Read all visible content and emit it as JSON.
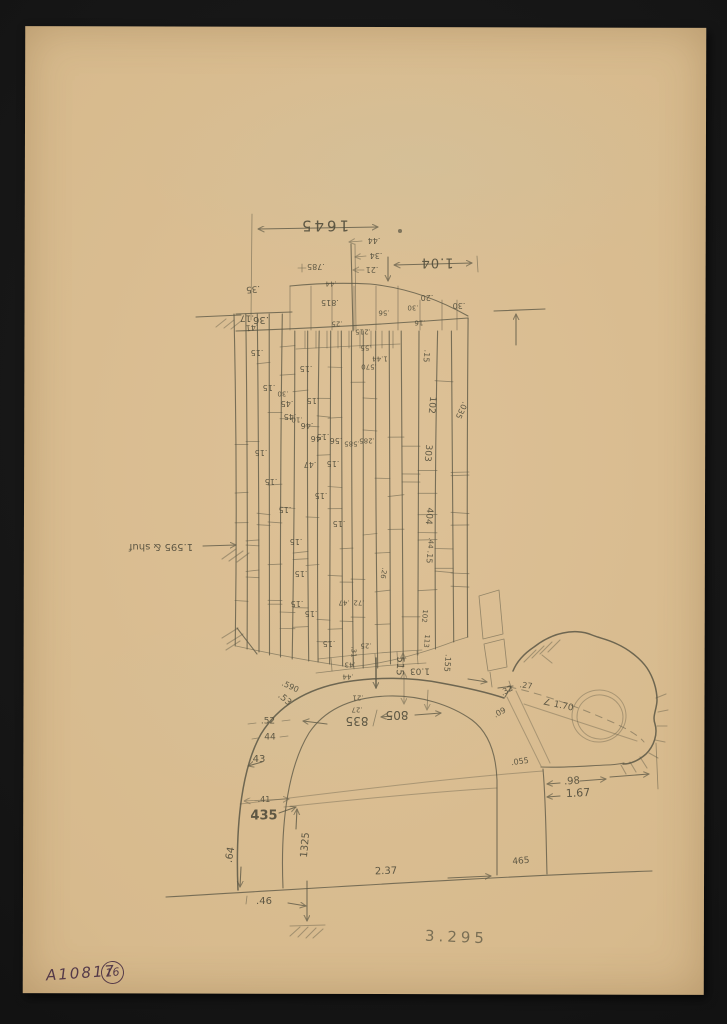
{
  "catalog": {
    "number": "A10817",
    "sheet": "16"
  },
  "plate_number": "3.295",
  "colors": {
    "paper": "#d7ba8d",
    "pencil": "#5b5745",
    "ink": "#4a3044",
    "background": "#141414"
  },
  "notes": {
    "orientation": "most pencil dimensions are written upside-down (sheet was annotated rotated 180°)",
    "subject": "dimensioned pencil sketch of masonry coursework above an arched tunnel profile with rock cavity at right"
  },
  "annotations": [
    {
      "t": "1645",
      "x": 324,
      "y": 225,
      "r": 180,
      "s": 15,
      "ls": 3
    },
    {
      "t": "1.04",
      "x": 437,
      "y": 262,
      "r": 180,
      "s": 13,
      "ls": 1
    },
    {
      "t": ".44",
      "x": 374,
      "y": 240,
      "r": 180,
      "s": 8
    },
    {
      "t": ".34",
      "x": 376,
      "y": 255,
      "r": 180,
      "s": 8
    },
    {
      "t": ".21",
      "x": 372,
      "y": 269,
      "r": 180,
      "s": 8
    },
    {
      "t": ".785",
      "x": 316,
      "y": 266,
      "r": 180,
      "s": 8
    },
    {
      "t": ".35",
      "x": 253,
      "y": 288,
      "r": 175,
      "s": 9
    },
    {
      "t": ".41",
      "x": 252,
      "y": 327,
      "r": 175,
      "s": 8
    },
    {
      "t": ".17",
      "x": 247,
      "y": 317,
      "r": 180,
      "s": 9
    },
    {
      "t": ".36",
      "x": 261,
      "y": 319,
      "r": 180,
      "s": 10
    },
    {
      "t": ".815",
      "x": 330,
      "y": 302,
      "r": 180,
      "s": 8
    },
    {
      "t": ".44",
      "x": 331,
      "y": 283,
      "r": 180,
      "s": 7
    },
    {
      "t": ".20",
      "x": 427,
      "y": 297,
      "r": 180,
      "s": 8
    },
    {
      "t": ".30",
      "x": 459,
      "y": 305,
      "r": 180,
      "s": 8
    },
    {
      "t": ".16",
      "x": 420,
      "y": 322,
      "r": 180,
      "s": 7
    },
    {
      "t": ".25",
      "x": 337,
      "y": 323,
      "r": 180,
      "s": 7
    },
    {
      "t": ".56",
      "x": 384,
      "y": 312,
      "r": 180,
      "s": 7
    },
    {
      "t": ".215",
      "x": 363,
      "y": 331,
      "r": 180,
      "s": 7
    },
    {
      "t": ".30",
      "x": 413,
      "y": 307,
      "r": 180,
      "s": 7
    },
    {
      "t": ".15",
      "x": 257,
      "y": 352,
      "r": 180,
      "s": 8
    },
    {
      "t": ".15",
      "x": 269,
      "y": 387,
      "r": 180,
      "s": 8
    },
    {
      "t": ".15",
      "x": 261,
      "y": 452,
      "r": 180,
      "s": 8
    },
    {
      "t": ".15",
      "x": 271,
      "y": 481,
      "r": 180,
      "s": 8
    },
    {
      "t": ".15",
      "x": 285,
      "y": 509,
      "r": 180,
      "s": 8
    },
    {
      "t": ".15",
      "x": 296,
      "y": 541,
      "r": 180,
      "s": 8
    },
    {
      "t": ".15",
      "x": 301,
      "y": 573,
      "r": 180,
      "s": 8
    },
    {
      "t": ".15",
      "x": 297,
      "y": 603,
      "r": 180,
      "s": 8
    },
    {
      "t": ".15",
      "x": 306,
      "y": 368,
      "r": 180,
      "s": 8
    },
    {
      "t": ".15",
      "x": 313,
      "y": 400,
      "r": 180,
      "s": 8
    },
    {
      "t": ".15",
      "x": 323,
      "y": 436,
      "r": 180,
      "s": 8
    },
    {
      "t": ".15",
      "x": 333,
      "y": 463,
      "r": 180,
      "s": 8
    },
    {
      "t": ".15",
      "x": 321,
      "y": 495,
      "r": 180,
      "s": 8
    },
    {
      "t": ".15",
      "x": 339,
      "y": 523,
      "r": 180,
      "s": 8
    },
    {
      "t": ".15",
      "x": 311,
      "y": 613,
      "r": 180,
      "s": 8
    },
    {
      "t": ".15",
      "x": 329,
      "y": 643,
      "r": 180,
      "s": 8
    },
    {
      "t": ".15",
      "x": 426,
      "y": 356,
      "r": 95,
      "s": 8
    },
    {
      "t": ".15",
      "x": 429,
      "y": 557,
      "r": 95,
      "s": 8
    },
    {
      "t": ".30",
      "x": 283,
      "y": 393,
      "r": 180,
      "s": 7
    },
    {
      "t": ".10",
      "x": 297,
      "y": 419,
      "r": 180,
      "s": 7
    },
    {
      "t": ".45",
      "x": 287,
      "y": 403,
      "r": 180,
      "s": 8
    },
    {
      "t": ".45",
      "x": 290,
      "y": 416,
      "r": 180,
      "s": 8
    },
    {
      "t": ".46",
      "x": 307,
      "y": 425,
      "r": 180,
      "s": 8
    },
    {
      "t": ".46",
      "x": 317,
      "y": 438,
      "r": 180,
      "s": 8
    },
    {
      "t": ".47",
      "x": 310,
      "y": 464,
      "r": 180,
      "s": 8
    },
    {
      "t": ".47",
      "x": 344,
      "y": 602,
      "r": 180,
      "s": 7
    },
    {
      "t": ".56",
      "x": 336,
      "y": 440,
      "r": 180,
      "s": 8
    },
    {
      "t": ".585",
      "x": 352,
      "y": 443,
      "r": 180,
      "s": 7
    },
    {
      "t": ".570",
      "x": 369,
      "y": 366,
      "r": 180,
      "s": 7
    },
    {
      "t": "1.44",
      "x": 380,
      "y": 358,
      "r": 180,
      "s": 7
    },
    {
      "t": ".55",
      "x": 366,
      "y": 347,
      "r": 180,
      "s": 7
    },
    {
      "t": ".285",
      "x": 367,
      "y": 440,
      "r": 180,
      "s": 7
    },
    {
      "t": ".26",
      "x": 383,
      "y": 573,
      "r": 100,
      "s": 7
    },
    {
      "t": ".72",
      "x": 359,
      "y": 602,
      "r": 180,
      "s": 7
    },
    {
      "t": ".25",
      "x": 366,
      "y": 645,
      "r": 180,
      "s": 7
    },
    {
      "t": ".31",
      "x": 353,
      "y": 652,
      "r": 90,
      "s": 7
    },
    {
      "t": "102",
      "x": 431,
      "y": 405,
      "r": 95,
      "s": 9
    },
    {
      "t": "303",
      "x": 427,
      "y": 453,
      "r": 95,
      "s": 9
    },
    {
      "t": "404",
      "x": 428,
      "y": 516,
      "r": 95,
      "s": 9
    },
    {
      "t": "102",
      "x": 424,
      "y": 616,
      "r": 95,
      "s": 7
    },
    {
      "t": "113",
      "x": 426,
      "y": 641,
      "r": 95,
      "s": 7
    },
    {
      "t": ".035",
      "x": 461,
      "y": 410,
      "r": 115,
      "s": 8
    },
    {
      "t": ".44",
      "x": 430,
      "y": 543,
      "r": 95,
      "s": 7
    },
    {
      "t": ".155",
      "x": 447,
      "y": 663,
      "r": 95,
      "s": 8
    },
    {
      "t": "515",
      "x": 399,
      "y": 666,
      "r": 93,
      "s": 10
    },
    {
      "t": "1.03",
      "x": 420,
      "y": 670,
      "r": 180,
      "s": 9
    },
    {
      "t": ".43",
      "x": 350,
      "y": 664,
      "r": 180,
      "s": 7
    },
    {
      "t": ".44",
      "x": 348,
      "y": 676,
      "r": 180,
      "s": 7
    },
    {
      "t": ".21",
      "x": 358,
      "y": 697,
      "r": 180,
      "s": 7
    },
    {
      "t": ".27",
      "x": 357,
      "y": 709,
      "r": 180,
      "s": 7
    },
    {
      "t": ".590",
      "x": 290,
      "y": 687,
      "r": 25,
      "s": 8
    },
    {
      "t": ".53",
      "x": 284,
      "y": 700,
      "r": 40,
      "s": 9
    },
    {
      "t": ".52",
      "x": 268,
      "y": 722,
      "s": 9
    },
    {
      "t": "44",
      "x": 270,
      "y": 738,
      "s": 9
    },
    {
      "t": "43",
      "x": 259,
      "y": 760,
      "s": 10
    },
    {
      "t": ".41",
      "x": 264,
      "y": 800,
      "s": 8
    },
    {
      "t": "435",
      "x": 264,
      "y": 816,
      "s": 13,
      "b": true
    },
    {
      "t": "1325",
      "x": 306,
      "y": 845,
      "r": -85,
      "s": 10
    },
    {
      "t": ".64",
      "x": 231,
      "y": 855,
      "r": -80,
      "s": 10
    },
    {
      "t": ".46",
      "x": 264,
      "y": 902,
      "s": 10
    },
    {
      "t": "835",
      "x": 357,
      "y": 721,
      "r": 180,
      "s": 12
    },
    {
      "t": "805",
      "x": 397,
      "y": 715,
      "r": 180,
      "s": 12
    },
    {
      "t": "2.37",
      "x": 386,
      "y": 872,
      "r": -2,
      "s": 10
    },
    {
      "t": "465",
      "x": 521,
      "y": 862,
      "r": -5,
      "s": 9
    },
    {
      "t": ".27",
      "x": 526,
      "y": 686,
      "r": 8,
      "s": 8
    },
    {
      "t": ".32",
      "x": 507,
      "y": 691,
      "r": -28,
      "s": 8
    },
    {
      "t": ".09",
      "x": 500,
      "y": 713,
      "r": -28,
      "s": 8
    },
    {
      "t": "∠ 1.70",
      "x": 558,
      "y": 706,
      "r": 12,
      "s": 9
    },
    {
      "t": ".055",
      "x": 520,
      "y": 762,
      "r": -8,
      "s": 8
    },
    {
      "t": ".98",
      "x": 572,
      "y": 782,
      "r": -4,
      "s": 10
    },
    {
      "t": "1.67",
      "x": 578,
      "y": 793,
      "r": -3,
      "s": 11
    },
    {
      "t": "1.595 & shuf",
      "x": 161,
      "y": 546,
      "r": 180,
      "s": 10
    }
  ]
}
